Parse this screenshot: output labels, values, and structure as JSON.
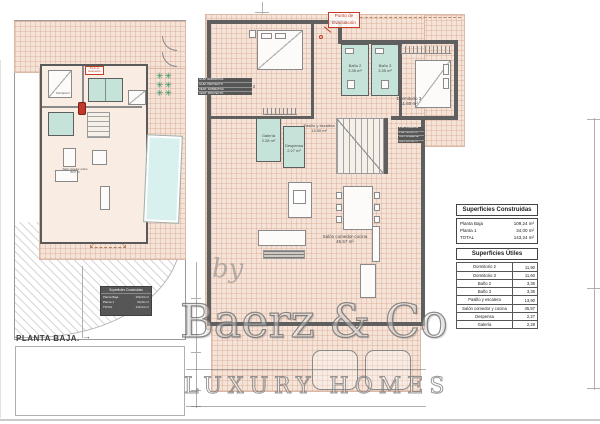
{
  "titles": {
    "left_plan": "PLANTA BAJA."
  },
  "evac": {
    "l1": "Punto de",
    "l2": "Evacuación"
  },
  "rooms": {
    "dormitorio2": {
      "name": "Dormitorio 2",
      "area": "11.90 m²"
    },
    "bano2": {
      "name": "Baño 2",
      "area": "3.35 m²"
    },
    "bano3": {
      "name": "Baño 3",
      "area": "3.35 m²"
    },
    "dormitorio3": {
      "name": "Dormitorio 3",
      "area": "11.60 m²"
    },
    "pasillo": {
      "name": "Pasillo y escalera",
      "area": "13.50 m²"
    },
    "galeria": {
      "name": "Galería",
      "area": "2.28 m²"
    },
    "despensa": {
      "name": "Despensa",
      "area": "2.27 m²"
    },
    "salon": {
      "name": "Salón comedor-cocina",
      "area": "45.57 m²"
    }
  },
  "tables": {
    "construidas": {
      "title": "Superficies Construidas",
      "rows": [
        [
          "Planta Baja",
          "109,24 m²"
        ],
        [
          "Planta 1",
          "34,00 m²"
        ],
        [
          "TOTAL",
          "143,24 m²"
        ]
      ]
    },
    "utiles": {
      "title": "Superficies Útiles",
      "rows": [
        [
          "Dormitorio 2",
          "11,90"
        ],
        [
          "Dormitorio 3",
          "11,60"
        ],
        [
          "Baño 2",
          "3,35"
        ],
        [
          "Baño 3",
          "3,35"
        ],
        [
          "Pasillo y escalera",
          "13,90"
        ],
        [
          "Salón comedor y cocina",
          "45,57"
        ],
        [
          "Despensa",
          "2,27"
        ],
        [
          "Galería",
          "2,28"
        ]
      ]
    }
  },
  "schedule": {
    "rows": [
      "ILUM. NORMATIVA",
      "ILUM. PROYECTO",
      "VENT. NORMATIVA",
      "VENT. PROYECTO"
    ]
  },
  "watermark": {
    "by": "by",
    "brand": "Baerz & Co",
    "tagline": "LUXURY HOMES"
  },
  "colors": {
    "floor": "#f5e3d8",
    "wall": "#5f5f5f",
    "wet_room": "#c6e3da",
    "pool": "#d9f1ee",
    "plants": "#2e8f5d",
    "accent_red": "#c23b22"
  }
}
